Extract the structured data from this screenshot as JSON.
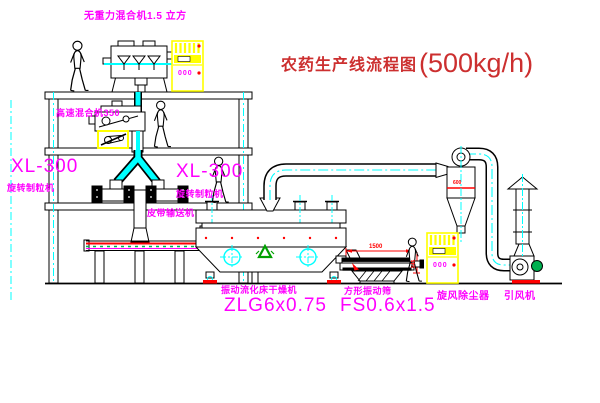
{
  "title": {
    "text": "农药生产线流程图",
    "capacity": "(500kg/h)"
  },
  "equipment_labels": {
    "gravity_mixer": "无重力混合机1.5 立方",
    "high_speed_mixer": "高速混合机350",
    "granulator_left_model": "XL-300",
    "granulator_left_name": "旋转制粒机",
    "granulator_right_model": "XL-300",
    "granulator_right_name": "旋转制粒机",
    "belt_conveyor": "皮带输送机",
    "dryer_name": "振动流化床干燥机",
    "dryer_model": "ZLG6x0.75",
    "sieve_name": "方形振动筛",
    "sieve_model": "FS0.6x1.5",
    "cyclone_name": "旋风除尘器",
    "fan_name": "引风机"
  },
  "dimensions": {
    "sieve_length": "1500",
    "sieve_height": "545",
    "cyclone_body": "600"
  },
  "control_cabinet": {
    "display_text": "000"
  },
  "colors": {
    "label_magenta": "#ff00ff",
    "title_red": "#cc2f2f",
    "equipment_yellow": "#ffff00",
    "centerline_cyan": "#00ffff",
    "accent_red": "#ff0000",
    "motor_green": "#00b050",
    "line_black": "#000000"
  }
}
